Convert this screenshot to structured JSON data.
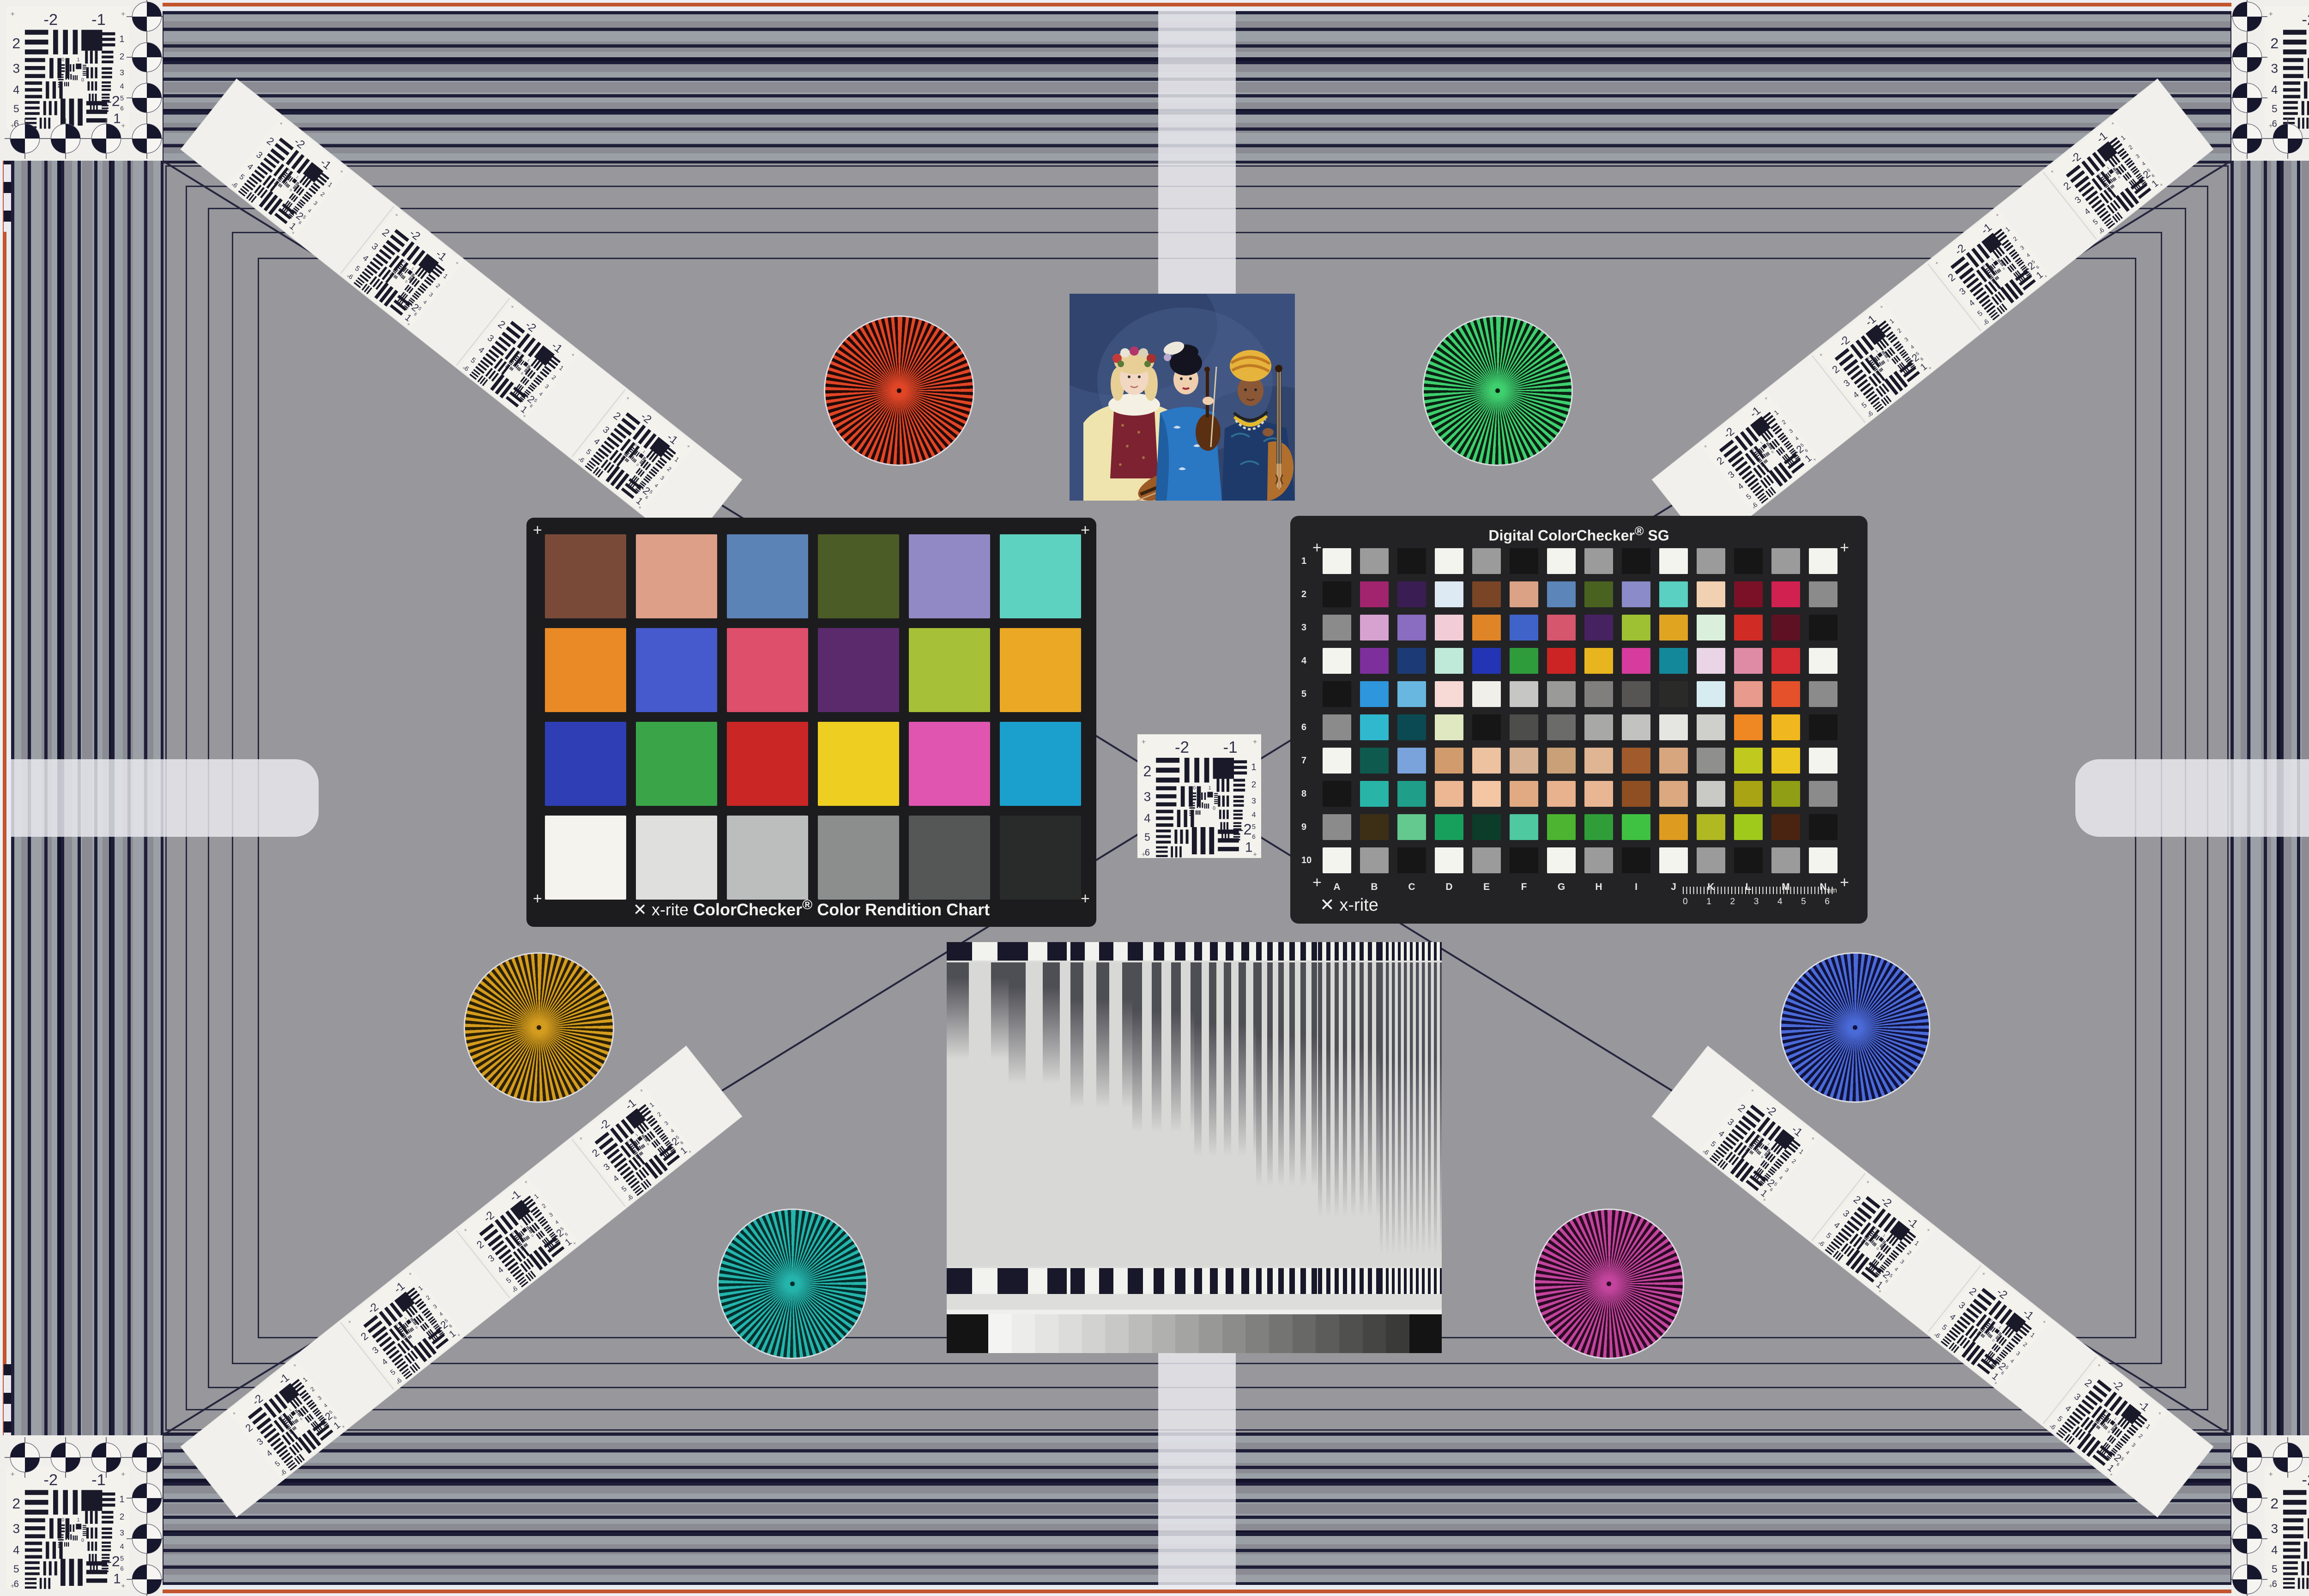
{
  "usaf": {
    "m2": "-2",
    "m1": "-1",
    "left": [
      "2",
      "3",
      "4",
      "5",
      "6"
    ],
    "right": [
      "1",
      "2",
      "3",
      "4",
      "5",
      "6"
    ],
    "b_label": "-2",
    "b_label2": "1",
    "c_zero": "0",
    "c_one": "1",
    "plus": "+"
  },
  "cc24": {
    "brand": "x-rite",
    "logo_glyph": "✕",
    "title": "ColorChecker",
    "reg": "®",
    "subtitle": "Color Rendition Chart",
    "colors": [
      "#7a4a39",
      "#dd9f88",
      "#5c83b6",
      "#4c5c27",
      "#9189c6",
      "#5ed2c0",
      "#e98a26",
      "#4659cd",
      "#dd4f6a",
      "#5a2a6d",
      "#a6c037",
      "#eba824",
      "#2f3eb4",
      "#3aa548",
      "#cb2626",
      "#eecf21",
      "#e055af",
      "#1ba0cd",
      "#f4f3ee",
      "#dfdfdd",
      "#bcbebd",
      "#8c8e8d",
      "#555757",
      "#292a2a"
    ]
  },
  "sg": {
    "title": "Digital ColorChecker",
    "reg": "®",
    "suffix": " SG",
    "brand": "x-rite",
    "logo_glyph": "✕",
    "rows": [
      "1",
      "2",
      "3",
      "4",
      "5",
      "6",
      "7",
      "8",
      "9",
      "10"
    ],
    "cols": [
      "A",
      "B",
      "C",
      "D",
      "E",
      "F",
      "G",
      "H",
      "I",
      "J",
      "K",
      "L",
      "M",
      "N"
    ],
    "ruler_ticks": [
      "0",
      "1",
      "2",
      "3",
      "4",
      "5",
      "6"
    ],
    "ruler_unit": "mm",
    "colors": [
      "#f4f4ef",
      "#9b9b9b",
      "#161616",
      "#f4f4ef",
      "#9b9b9b",
      "#161616",
      "#f4f4ef",
      "#9b9b9b",
      "#161616",
      "#f4f4ef",
      "#9b9b9b",
      "#161616",
      "#9b9b9b",
      "#f4f4ef",
      "#161616",
      "#a3246e",
      "#3a1d52",
      "#dde9f3",
      "#7a4526",
      "#dca285",
      "#5c85b9",
      "#4a6220",
      "#8b8bc9",
      "#59d0c1",
      "#f1d1b1",
      "#7b1126",
      "#d02151",
      "#8b8b8b",
      "#8b8b8b",
      "#d7a2d0",
      "#8a6cc0",
      "#f2cdd7",
      "#e08527",
      "#4063c9",
      "#d5566d",
      "#472260",
      "#9dc133",
      "#e1a421",
      "#daf0dc",
      "#d02c25",
      "#5d1123",
      "#161616",
      "#f4f4ef",
      "#7d2f9b",
      "#1c3a75",
      "#bfead9",
      "#2335b4",
      "#2f9c3c",
      "#cc2424",
      "#e9b51e",
      "#d63b9d",
      "#13889b",
      "#e9d5e6",
      "#e08ba6",
      "#d42a32",
      "#f4f4ef",
      "#161616",
      "#2d96dc",
      "#67b7e0",
      "#f7d9d5",
      "#f0efe9",
      "#c6c6c4",
      "#9a9a98",
      "#807f7d",
      "#565554",
      "#2a2a29",
      "#d7ecf0",
      "#e89a8c",
      "#e4512b",
      "#8b8b8b",
      "#8b8b8b",
      "#2fb9ce",
      "#0b4a52",
      "#dfe8c0",
      "#161616",
      "#4d4d4c",
      "#6b6b6a",
      "#a8a8a6",
      "#c2c2c0",
      "#e5e5e1",
      "#cfcfcc",
      "#ef8722",
      "#f0b81e",
      "#161616",
      "#f4f4ef",
      "#0f5a4e",
      "#7aa3dc",
      "#d29b6e",
      "#ecc2a0",
      "#d7b193",
      "#c9a077",
      "#e0b593",
      "#a05a2c",
      "#d8a67e",
      "#8f8f8d",
      "#c0ca1e",
      "#ecc620",
      "#f4f4ef",
      "#161616",
      "#28b5a8",
      "#1f9e8a",
      "#edb793",
      "#f4c6a4",
      "#e2aa82",
      "#e7b28d",
      "#e9b694",
      "#8f4f22",
      "#dca87f",
      "#c9c9c6",
      "#a8a414",
      "#8f9e14",
      "#8b8b8b",
      "#8b8b8b",
      "#3c2f16",
      "#63c98e",
      "#17a05c",
      "#0c3d2a",
      "#4ec9a0",
      "#4cb430",
      "#2f9e38",
      "#3fc242",
      "#dd9c1f",
      "#b0b822",
      "#9fca1c",
      "#4a2410",
      "#161616",
      "#f4f4ef",
      "#9b9b9b",
      "#161616",
      "#f4f4ef",
      "#9b9b9b",
      "#161616",
      "#f4f4ef",
      "#9b9b9b",
      "#161616",
      "#f4f4ef",
      "#9b9b9b",
      "#161616",
      "#9b9b9b",
      "#f4f4ef"
    ]
  },
  "grayscale": [
    "#141414",
    "#f4f4f2",
    "#ececea",
    "#e4e4e2",
    "#dcdcda",
    "#d2d2d0",
    "#c8c8c6",
    "#bcbcba",
    "#b0b0ae",
    "#a4a4a2",
    "#989896",
    "#8c8c8a",
    "#80807e",
    "#747472",
    "#686866",
    "#5c5c5a",
    "#50504e",
    "#454543",
    "#3a3a38",
    "#141414"
  ],
  "stars": {
    "red": {
      "c1": "#e04526",
      "c2": "#230a08"
    },
    "green": {
      "c1": "#3ecf6e",
      "c2": "#0a2112"
    },
    "gold": {
      "c1": "#d49c1e",
      "c2": "#2c2104"
    },
    "blue": {
      "c1": "#4a6ad8",
      "c2": "#10123e"
    },
    "teal": {
      "c1": "#25b4ac",
      "c2": "#03302d"
    },
    "magenta": {
      "c1": "#c2449c",
      "c2": "#2c0a24"
    }
  }
}
